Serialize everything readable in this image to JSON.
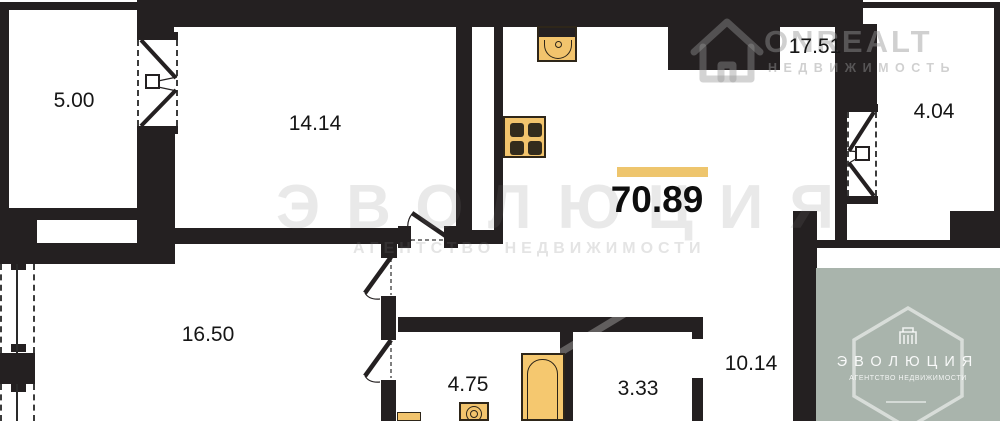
{
  "plan": {
    "type": "apartment-floor-plan",
    "total_area": "70.89",
    "rooms": [
      {
        "name": "balcony-left",
        "area": "5.00"
      },
      {
        "name": "bedroom",
        "area": "14.14"
      },
      {
        "name": "kitchen-living",
        "area": "17.51"
      },
      {
        "name": "balcony-right",
        "area": "4.04"
      },
      {
        "name": "living-room",
        "area": "16.50"
      },
      {
        "name": "bathroom",
        "area": "4.75"
      },
      {
        "name": "wc",
        "area": "3.33"
      },
      {
        "name": "hallway",
        "area": "10.14"
      }
    ],
    "fixtures": [
      "kitchen-sink",
      "stove",
      "bathtub",
      "toilet",
      "washbasin"
    ],
    "colors": {
      "wall": "#242021",
      "fixture_fill": "#f2c46d",
      "fixture_dark": "#332c1d",
      "accent_bar": "#eec56d",
      "badge_background": "#a9b4ac"
    }
  },
  "watermarks": {
    "onrealt": {
      "title": "ONREALT",
      "subtitle": "НЕДВИЖИМОСТЬ",
      "icon": "house-icon"
    },
    "evolution_text": {
      "title": "ЭВОЛЮЦИЯ",
      "subtitle": "АГЕНТСТВО НЕДВИЖИМОСТИ"
    },
    "evolution_badge": {
      "title": "ЭВОЛЮЦИЯ",
      "subtitle": "АГЕНТСТВО НЕДВИЖИМОСТИ",
      "icons": [
        "hexagon-icon",
        "building-icon"
      ]
    }
  }
}
